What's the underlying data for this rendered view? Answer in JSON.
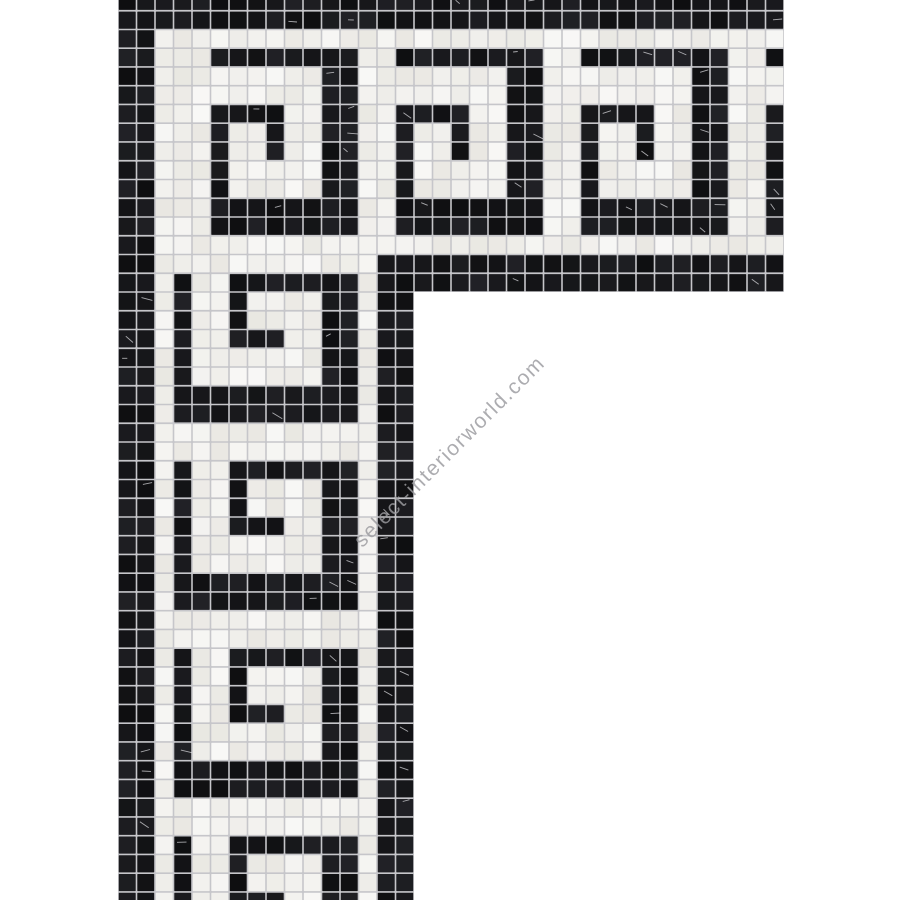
{
  "image": {
    "width": 900,
    "height": 900,
    "background": "#ffffff",
    "subject": "Greek key mosaic tile border, black and white marble, L-shaped corner section product photo"
  },
  "watermark": {
    "text": "select-interiorworld.com",
    "color": "#9b9b9f",
    "opacity": 0.82,
    "rotation_deg": -45,
    "font_size_px": 21,
    "center_x": 450,
    "center_y": 452
  },
  "mosaic": {
    "tile_black": "#17171b",
    "tile_white": "#f3f1ea",
    "grout_color": "#c6c6ca",
    "vein_color": "#e8e8ec",
    "tile_pitch_x": 18.5,
    "tile_pitch_y": 18.75,
    "tile_gap": 1.6,
    "origin_x": 118,
    "origin_y": -8,
    "top_band": {
      "x": 118,
      "y": 0,
      "width": 666,
      "height": 292,
      "tile_cols": 36,
      "tile_rows": 16
    },
    "left_band": {
      "x": 118,
      "y": 0,
      "width": 296,
      "height": 900,
      "tile_cols": 16,
      "tile_rows": 49
    },
    "band_structure": {
      "outer_black_rows": 2,
      "outer_white_rows": 1,
      "field_rows": 10,
      "inner_white_rows": 1,
      "inner_black_rows": 2
    },
    "pattern_unit_size": 10,
    "pattern_unit": [
      "WWBBBBBBBB",
      "WWWWWWWWBB",
      "WWWWWWWWBB",
      "WWBBBBWWBB",
      "WWBWWBWWBB",
      "WWBWWBWWBB",
      "WWBWWWWWBB",
      "WWBWWWWWBB",
      "WWBBBBBBBB",
      "WWBBBBBBBB"
    ]
  }
}
